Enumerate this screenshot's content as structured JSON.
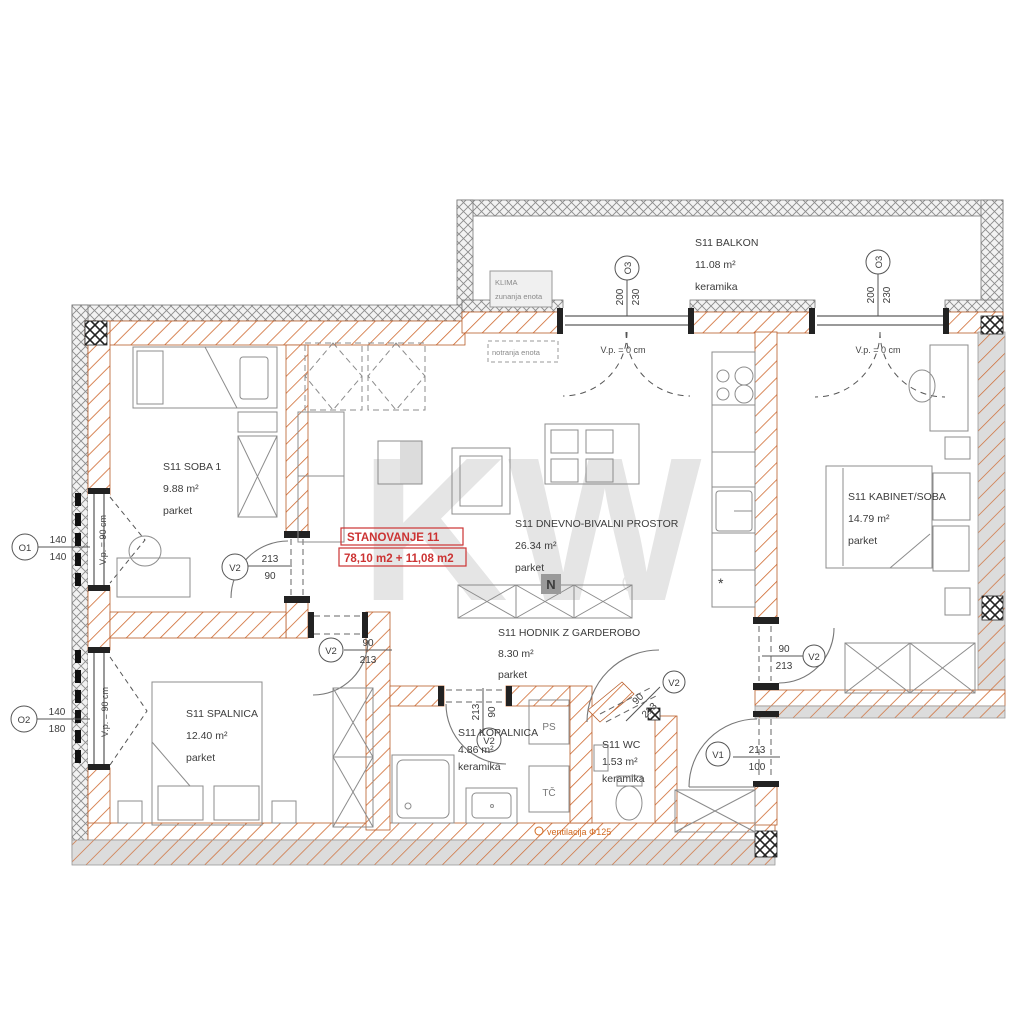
{
  "meta": {
    "watermark": "KW",
    "registered": "®",
    "north_badge": "N"
  },
  "apartment": {
    "name": "STANOVANJE 11",
    "area_sum": "78,10 m2 + 11,08 m2"
  },
  "rooms": {
    "soba1": {
      "name": "S11 SOBA 1",
      "area": "9.88 m²",
      "floor": "parket"
    },
    "dnevno": {
      "name": "S11 DNEVNO-BIVALNI PROSTOR",
      "area": "26.34 m²",
      "floor": "parket"
    },
    "hodnik": {
      "name": "S11 HODNIK Z GARDEROBO",
      "area": "8.30 m²",
      "floor": "parket"
    },
    "kabinet": {
      "name": "S11 KABINET/SOBA",
      "area": "14.79 m²",
      "floor": "parket"
    },
    "spalnica": {
      "name": "S11 SPALNICA",
      "area": "12.40 m²",
      "floor": "parket"
    },
    "kopalnica": {
      "name": "S11 KOPALNICA",
      "area": "4.86 m²",
      "floor": "keramika"
    },
    "wc": {
      "name": "S11 WC",
      "area": "1.53 m²",
      "floor": "keramika"
    },
    "balkon": {
      "name": "S11 BALKON",
      "area": "11.08 m²",
      "floor": "keramika"
    }
  },
  "tags": {
    "o1": {
      "label": "O1",
      "top": "140",
      "bottom": "140"
    },
    "o2": {
      "label": "O2",
      "top": "140",
      "bottom": "180"
    },
    "o3a": {
      "label": "O3",
      "top": "200",
      "bottom": "230"
    },
    "o3b": {
      "label": "O3",
      "top": "200",
      "bottom": "230"
    },
    "v2_soba1": {
      "label": "V2",
      "top": "213",
      "bottom": "90"
    },
    "v2_spalnica": {
      "label": "V2",
      "top": "90",
      "bottom": "213"
    },
    "v2_kopalnica": {
      "label": "V2",
      "top": "213",
      "bottom": "90"
    },
    "v2_wc": {
      "label": "V2",
      "top": "90",
      "bottom": "213"
    },
    "v2_kabinet": {
      "label": "V2",
      "top": "90",
      "bottom": "213"
    },
    "v1_vhod": {
      "label": "V1",
      "top": "213",
      "bottom": "100"
    }
  },
  "annotations": {
    "vp90": "V.p. = 90 cm",
    "vp0": "V.p. = 0 cm",
    "klima_title": "KLIMA",
    "klima_sub": "zunanja enota",
    "notranja": "notranja enota",
    "ventilacija": "ventilacija Φ125",
    "ps": "PS",
    "tc": "TČ",
    "asterisk": "*"
  },
  "colors": {
    "wall_orange": "#c9672f",
    "wall_gray": "#d9d9d9",
    "lattice_gray": "#8c8c8c",
    "accent_red": "#cc3333",
    "text": "#3c3c3c",
    "watermark": "#e5e5e5"
  }
}
